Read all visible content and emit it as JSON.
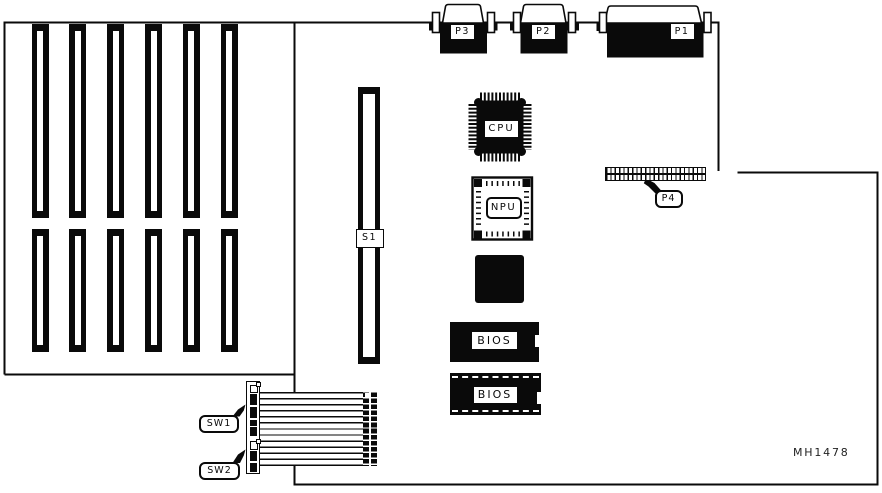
{
  "figure_code": "MH1478",
  "colors": {
    "line": "#0a0a0a",
    "background": "#ffffff"
  },
  "connectors": {
    "p1": {
      "label": "P1"
    },
    "p2": {
      "label": "P2"
    },
    "p3": {
      "label": "P3"
    },
    "p4": {
      "label": "P4"
    }
  },
  "chips": {
    "cpu": {
      "label": "CPU"
    },
    "npu": {
      "label": "NPU"
    },
    "bios1": {
      "label": "BIOS"
    },
    "bios2": {
      "label": "BIOS"
    }
  },
  "slots": {
    "s1": {
      "label": "S1"
    },
    "expansion_top_count": 6,
    "expansion_bottom_count": 6
  },
  "switches": {
    "sw1": {
      "label": "SW1"
    },
    "sw2": {
      "label": "SW2"
    }
  }
}
